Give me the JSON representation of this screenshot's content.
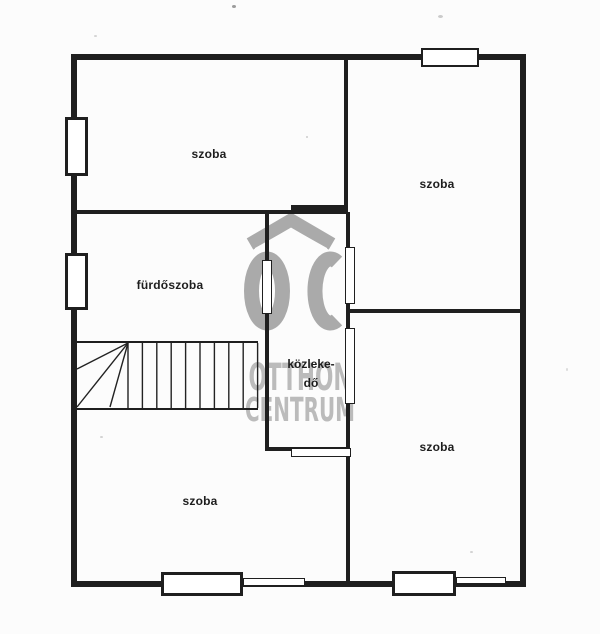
{
  "floorplan": {
    "rooms": [
      {
        "name": "room-top-left",
        "label": "szoba"
      },
      {
        "name": "room-top-right",
        "label": "szoba"
      },
      {
        "name": "bathroom",
        "label": "fürdőszoba"
      },
      {
        "name": "hallway",
        "label_line1": "közleke-",
        "label_line2": "dő"
      },
      {
        "name": "room-bottom-left",
        "label": "szoba"
      },
      {
        "name": "room-bottom-right",
        "label": "szoba"
      }
    ],
    "watermark": {
      "monogram": "OC",
      "name_line1": "OTTHON",
      "name_line2": "CENTRUM"
    },
    "colors": {
      "wall": "#1f1f1f",
      "background": "#fcfcfc",
      "watermark_logo": "#949494",
      "watermark_text": "#a9a9a9"
    }
  }
}
